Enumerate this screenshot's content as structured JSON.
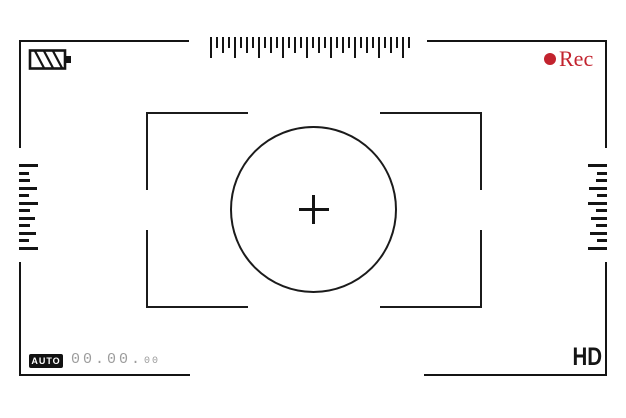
{
  "header": {
    "rec_label": "Rec",
    "rec_color": "#c2232e"
  },
  "footer": {
    "auto_label": "AUTO",
    "counter_main": "00.00.",
    "counter_small": "00",
    "hd_label": "HD"
  },
  "colors": {
    "frame": "#141414",
    "rec_red": "#c2232e",
    "counter_gray": "#9c9c9c"
  },
  "scales": {
    "top_ruler": {
      "tick_count": 34,
      "heights_pattern": [
        21,
        11,
        16,
        11
      ]
    },
    "left_scale": {
      "lengths": [
        19,
        10,
        11,
        18,
        10,
        19,
        11,
        16,
        11,
        17,
        10,
        19
      ]
    },
    "right_scale": {
      "lengths": [
        19,
        10,
        11,
        18,
        10,
        19,
        11,
        16,
        11,
        17,
        10,
        19
      ]
    }
  },
  "icons": {
    "battery": "battery-hatched-icon",
    "record": "record-dot-icon",
    "crosshair": "crosshair-icon"
  }
}
